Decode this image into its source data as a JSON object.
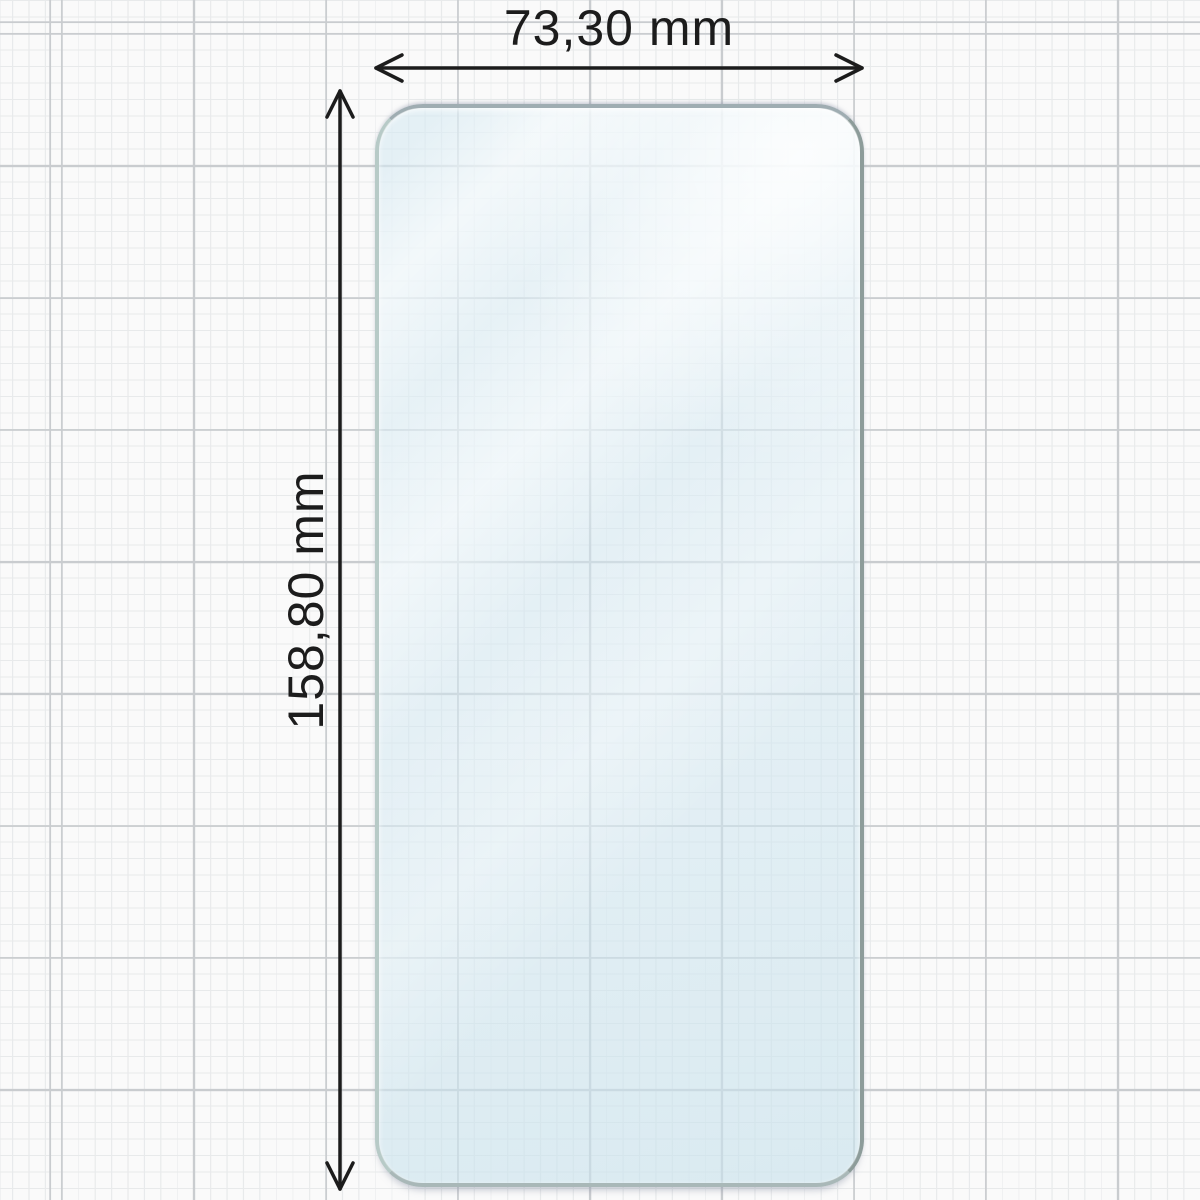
{
  "diagram": {
    "subject": "screen-protector-film",
    "width_dimension": {
      "label": "73,30 mm",
      "value_mm": 73.3,
      "unit": "mm"
    },
    "height_dimension": {
      "label": "158,80 mm",
      "value_mm": 158.8,
      "unit": "mm"
    }
  },
  "colors": {
    "background": "#fafafa",
    "grid_minor": "#e8eaeb",
    "grid_major": "#c9cccf",
    "film_fill": "#d8eaf3",
    "film_edge": "#8d9c9a",
    "dimension_ink": "#1c1c1c"
  }
}
